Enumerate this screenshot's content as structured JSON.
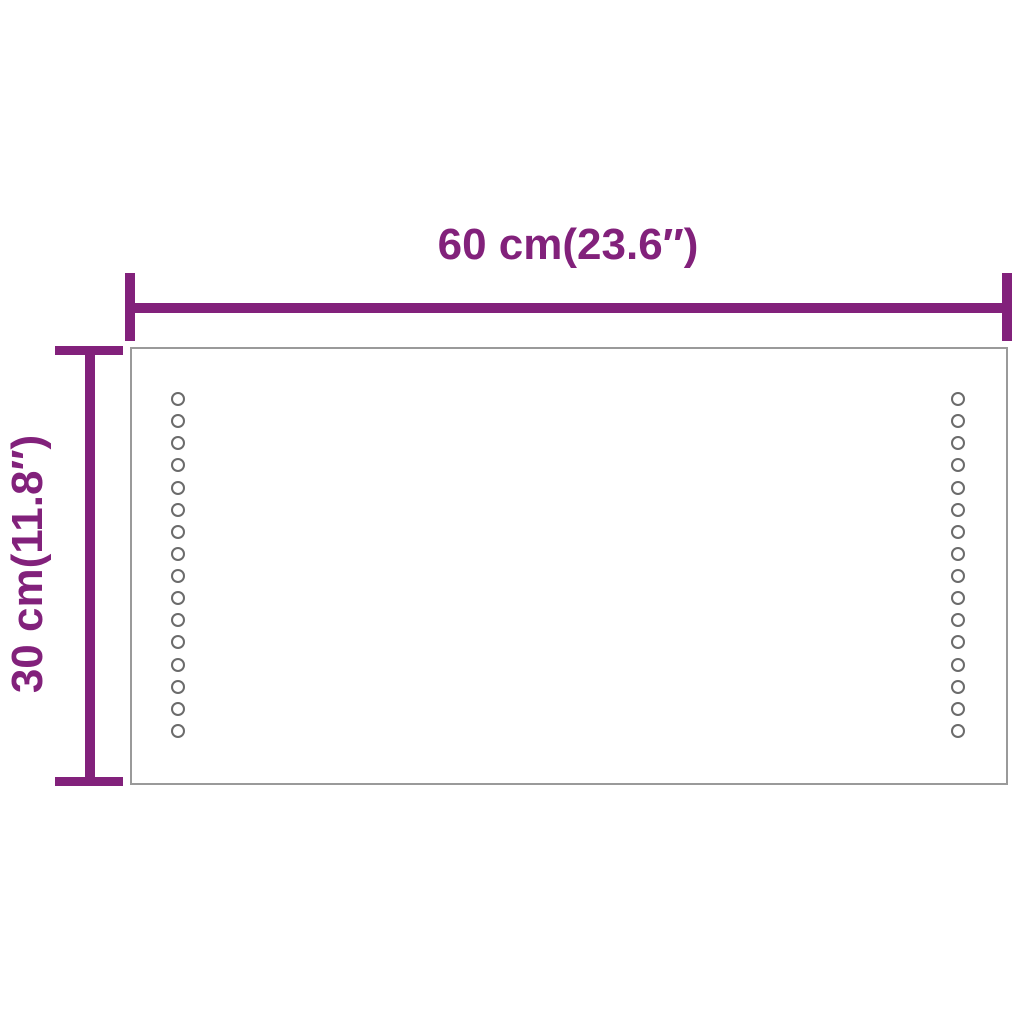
{
  "diagram": {
    "type": "product-dimension-diagram",
    "subject": "rectangular LED mirror shown face-on with two vertical columns of LED dots",
    "background_color": "#FFFFFF",
    "dimension_color": "#82217B",
    "outline_color": "#9A9A9A",
    "led_dot_color": "#6B6B6B",
    "width_dimension": {
      "label": "60 cm(23.6″)",
      "value_cm": 60,
      "value_in": 23.6
    },
    "height_dimension": {
      "label": "30 cm(11.8″)",
      "value_cm": 30,
      "value_in": 11.8
    },
    "led_columns": {
      "count": 2,
      "dots_per_column": 16,
      "sides": [
        "left",
        "right"
      ]
    }
  }
}
